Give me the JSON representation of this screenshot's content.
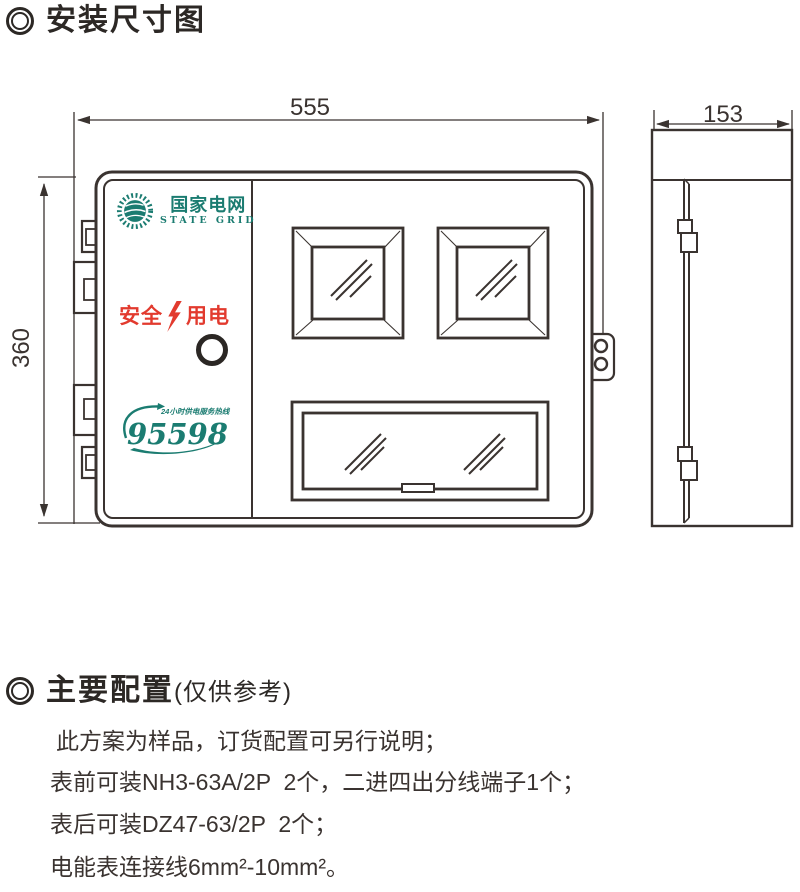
{
  "palette": {
    "ink": "#3a3330",
    "header_ink": "#2c2825",
    "brand_teal": "#1b7c71",
    "safety_red": "#e23a2e"
  },
  "sections": {
    "dim_title": "安装尺寸图",
    "config_title": "主要配置",
    "config_subtitle": "(仅供参考)"
  },
  "dimensions": {
    "width": "555",
    "height": "360",
    "depth": "153"
  },
  "front_view": {
    "brand": {
      "cn": "国家电网",
      "en": "STATE GRID"
    },
    "safety": {
      "left": "安全",
      "right": "用电"
    },
    "hotline": {
      "tagline": "24小时供电服务热线",
      "number": "95598"
    }
  },
  "config": {
    "lines": [
      "此方案为样品，订货配置可另行说明；",
      "表前可装NH3-63A/2P  2个，二进四出分线端子1个；",
      "表后可装DZ47-63/2P  2个；",
      "电能表连接线6mm²-10mm²。"
    ]
  }
}
